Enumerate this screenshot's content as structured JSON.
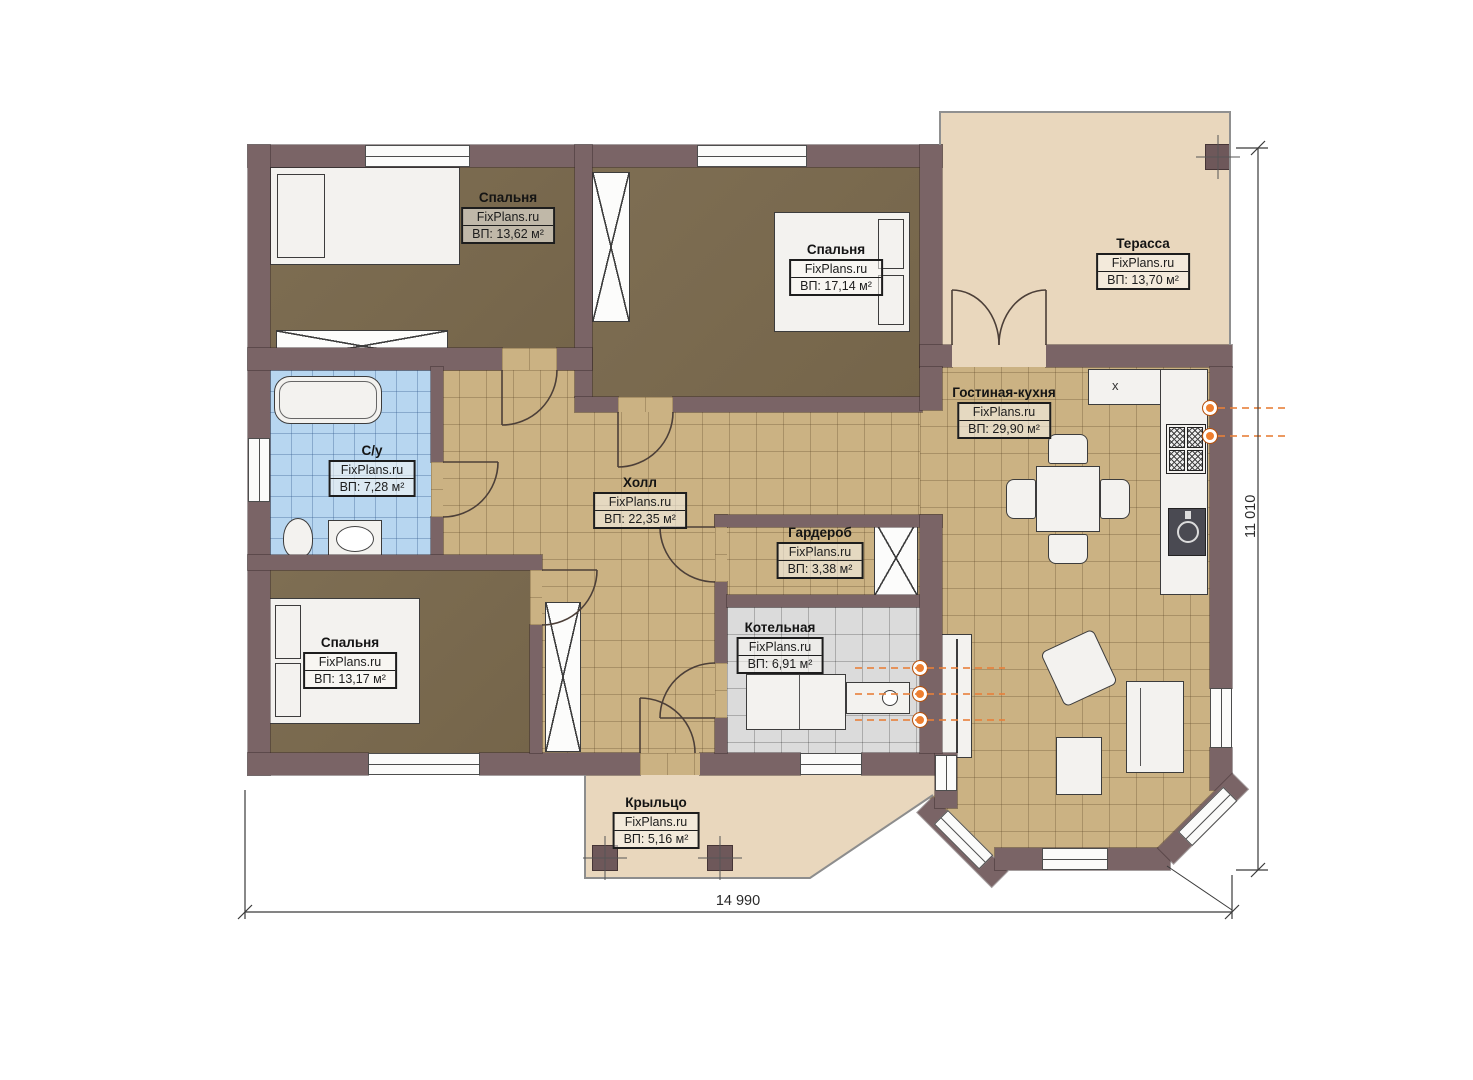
{
  "plan": {
    "brand": "FixPlans.ru",
    "rooms": [
      {
        "name": "Спальня",
        "area": "ВП: 13,62 м²"
      },
      {
        "name": "Спальня",
        "area": "ВП: 17,14 м²"
      },
      {
        "name": "Терасса",
        "area": "ВП: 13,70 м²"
      },
      {
        "name": "С/у",
        "area": "ВП: 7,28 м²"
      },
      {
        "name": "Холл",
        "area": "ВП: 22,35 м²"
      },
      {
        "name": "Гостиная-кухня",
        "area": "ВП: 29,90 м²"
      },
      {
        "name": "Гардероб",
        "area": "ВП: 3,38 м²"
      },
      {
        "name": "Спальня",
        "area": "ВП: 13,17 м²"
      },
      {
        "name": "Котельная",
        "area": "ВП: 6,91 м²"
      },
      {
        "name": "Крыльцо",
        "area": "ВП: 5,16 м²"
      }
    ],
    "dimensions": {
      "width": "14 990",
      "height": "11 010"
    },
    "marks": {
      "kitchen_cabinet": "x"
    },
    "colors": {
      "wall": "#7a6466",
      "bedroom_floor": "#7b6b51",
      "hall_tile": "#cbb283",
      "bath_tile": "#b7d6f0",
      "boiler_tile": "#dbdbdb",
      "terrace_floor": "#e9d7bd",
      "pipe_accent": "#e8803a"
    }
  }
}
